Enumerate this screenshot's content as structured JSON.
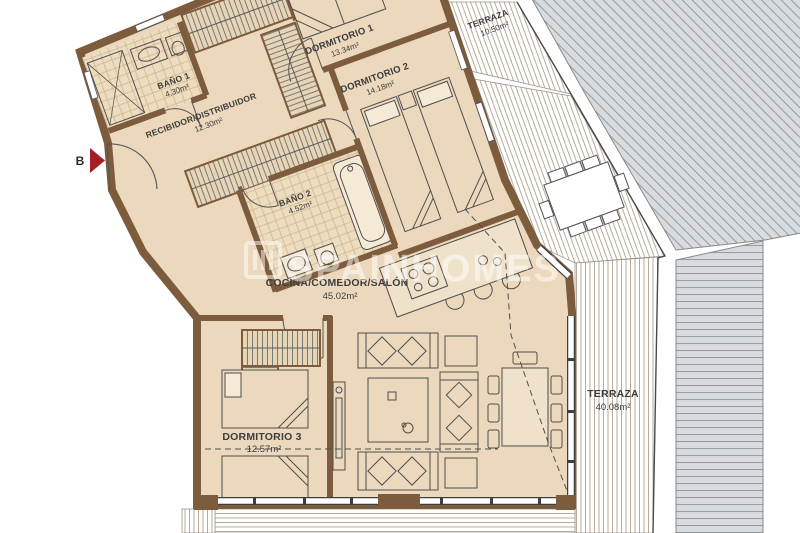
{
  "plan": {
    "title": "Apartment floor plan",
    "entry_label": "B",
    "watermark": {
      "text": "SPAINHOMES",
      "reg": "®"
    },
    "rooms": [
      {
        "id": "bano1",
        "name": "BAÑO 1",
        "area": "4.30m²"
      },
      {
        "id": "recibidor",
        "name": "RECIBIDOR/DISTRIBUIDOR",
        "area": "12.30m²"
      },
      {
        "id": "dormitorio1",
        "name": "DORMITORIO 1",
        "area": "13.34m²"
      },
      {
        "id": "dormitorio2",
        "name": "DORMITORIO 2",
        "area": "14.18m²"
      },
      {
        "id": "bano2",
        "name": "BAÑO 2",
        "area": "4.52m²"
      },
      {
        "id": "cocina",
        "name": "COCINA/COMEDOR/SALÓN",
        "area": "45.02m²"
      },
      {
        "id": "dormitorio3",
        "name": "DORMITORIO 3",
        "area": "12.57m²"
      },
      {
        "id": "terraza1",
        "name": "TERRAZA",
        "area": "10.50m²"
      },
      {
        "id": "terraza2",
        "name": "TERRAZA",
        "area": "40.08m²"
      }
    ],
    "colors": {
      "wall": "#7d5b3d",
      "floor": "#ecd9bd",
      "tile_line": "#cdb795",
      "deck_line": "#b7ab99",
      "neighbor_fill": "#d9dcde",
      "neighbor_line": "#989da2",
      "drawing_line": "#4e4e4e",
      "arrow_red": "#a32126"
    }
  }
}
